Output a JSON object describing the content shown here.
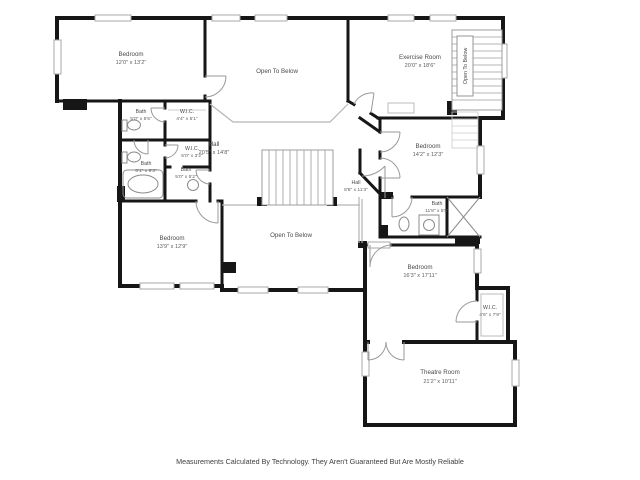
{
  "page": {
    "background": "#ffffff",
    "disclaimer": "Measurements Calculated By Technology. They Aren't Guaranteed But Are Mostly Reliable"
  },
  "colors": {
    "wall": "#161616",
    "window": "#a8a8a8",
    "door": "#9a9a9a",
    "rail": "#b5b5b5",
    "fixture": "#8c8c8c"
  },
  "rooms": [
    {
      "id": "bedroom-top-left",
      "name": "Bedroom",
      "dims": "12'0\" x 13'2\""
    },
    {
      "id": "open-to-below-top",
      "name": "Open To Below",
      "dims": ""
    },
    {
      "id": "exercise-room",
      "name": "Exercise Room",
      "dims": "20'0\" x 18'6\""
    },
    {
      "id": "stairs-open-to-below",
      "name": "Open To Below",
      "dims": ""
    },
    {
      "id": "bath-upper-left",
      "name": "Bath",
      "dims": "5'0\" x 5'5\""
    },
    {
      "id": "wic-upper",
      "name": "W.I.C.",
      "dims": "4'4\" x 5'1\""
    },
    {
      "id": "wic-middle",
      "name": "W.I.C.",
      "dims": "5'0\" x 3'2\""
    },
    {
      "id": "bath-left",
      "name": "Bath",
      "dims": "5'1\" x 9'3\""
    },
    {
      "id": "bath-middle",
      "name": "Bath",
      "dims": "5'0\" x 5'2\""
    },
    {
      "id": "hall-main",
      "name": "Hall",
      "dims": "20'5\" x 14'8\""
    },
    {
      "id": "hall-small",
      "name": "Hall",
      "dims": "8'8\" x 11'3\""
    },
    {
      "id": "bedroom-right",
      "name": "Bedroom",
      "dims": "14'2\" x 12'3\""
    },
    {
      "id": "bath-right",
      "name": "Bath",
      "dims": "11'8\" x 5'5\""
    },
    {
      "id": "open-to-below-center",
      "name": "Open To Below",
      "dims": ""
    },
    {
      "id": "bedroom-lower-left",
      "name": "Bedroom",
      "dims": "13'9\" x 12'9\""
    },
    {
      "id": "bedroom-bottom-right",
      "name": "Bedroom",
      "dims": "16'3\" x 17'11\""
    },
    {
      "id": "wic-bottom-right",
      "name": "W.I.C.",
      "dims": "4'6\" x 7'9\""
    },
    {
      "id": "theatre-room",
      "name": "Theatre Room",
      "dims": "21'2\" x 10'11\""
    }
  ]
}
